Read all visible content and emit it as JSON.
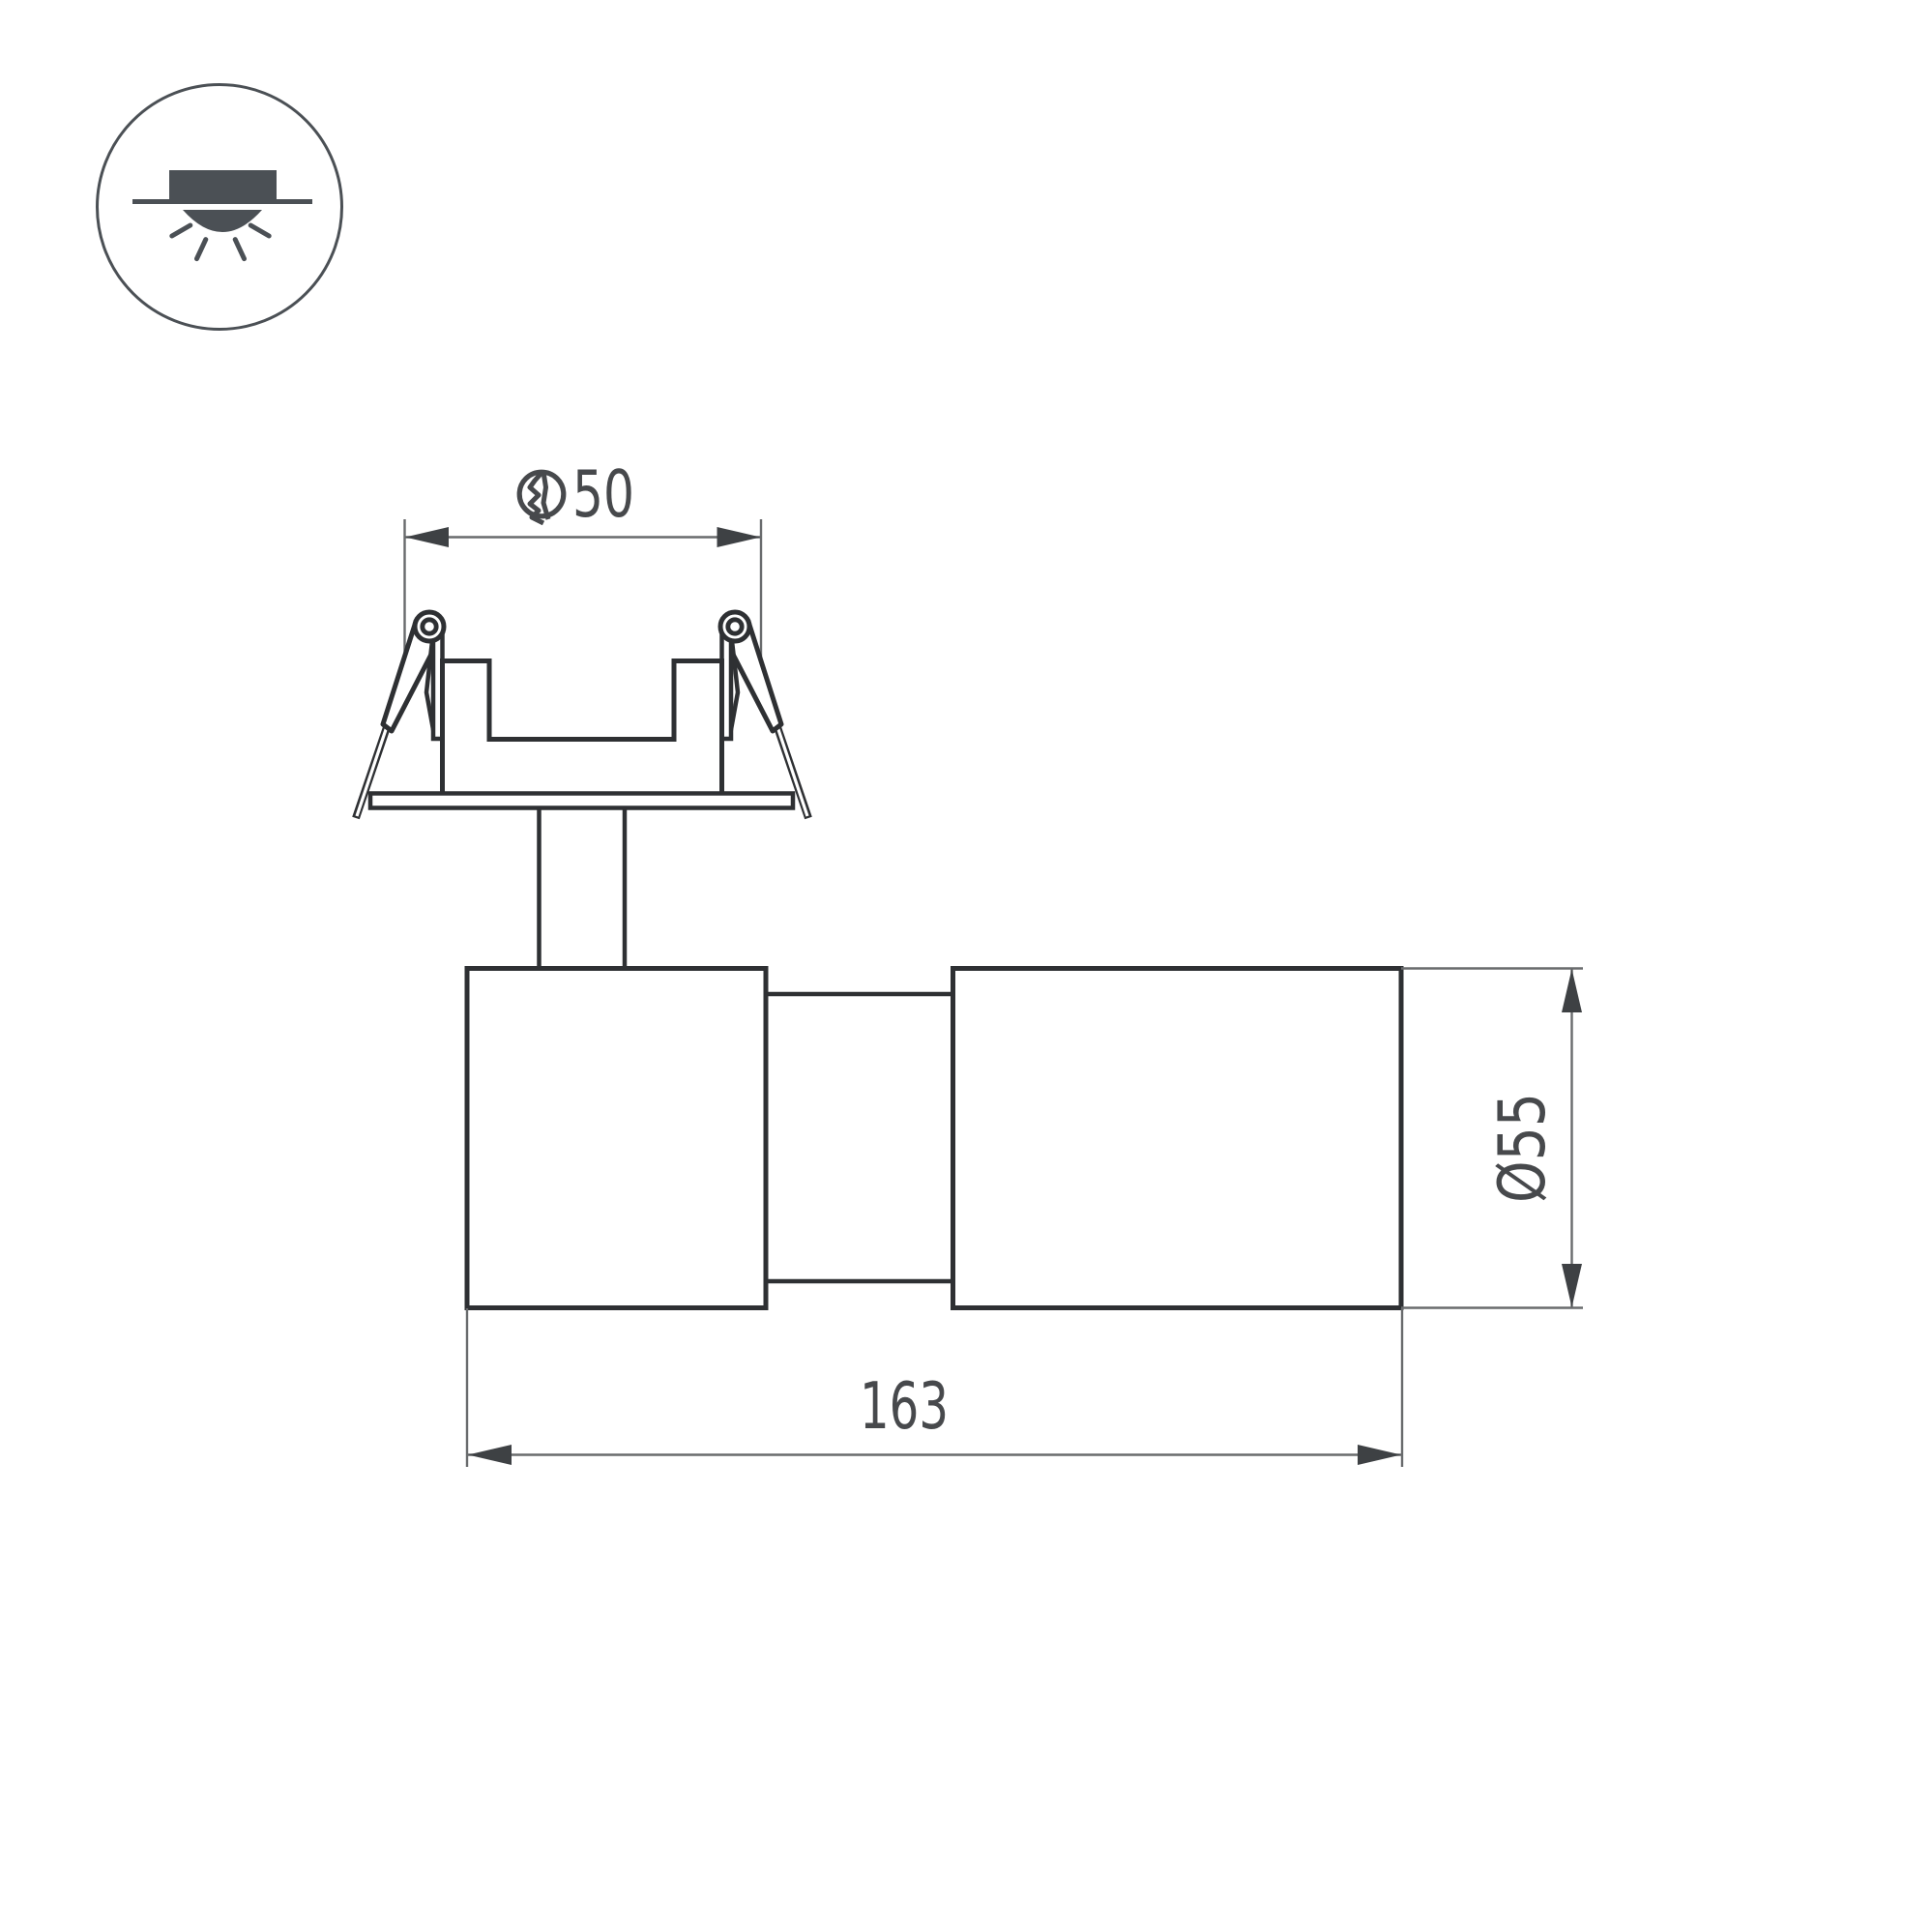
{
  "title": "Recessed spot luminaire dimension drawing",
  "colors": {
    "background": "#ffffff",
    "outline": "#2e3033",
    "icon": "#4b5055",
    "dim-line": "#696b6d",
    "arrow": "#3e4144",
    "text": "#47494c"
  },
  "badge": {
    "icon": "recessed-downlight-icon",
    "meaning": "recessed ceiling mount"
  },
  "dims": {
    "cutout": {
      "symbol": "cutout-hole-icon",
      "value": 50,
      "label": "50"
    },
    "length": {
      "value": 163,
      "label": "163"
    },
    "diameter": {
      "value": 55,
      "label": "Ø55"
    }
  }
}
